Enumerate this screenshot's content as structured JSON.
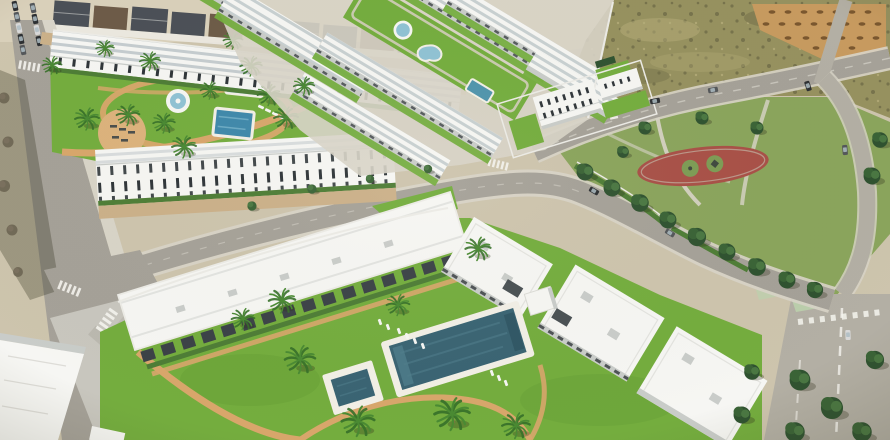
{
  "scene": {
    "type": "aerial-architectural-render",
    "description": "Aerial 3D render of a white Mediterranean residential development with landscaped gardens, swimming pools and palm trees, next to a public park, scrubland plots and asphalt roads",
    "areas": {
      "old_town": "Existing houses along the top edge",
      "left_street": "Tree-lined street with parked cars",
      "avenue": "Wide avenue at the lower-left intersection",
      "roads": "Asphalt access roads with zebra crossings",
      "complex1": "Upper apartment block with landscaped garden and pools",
      "complex2": "Diagonal townhouse rows around a linear lawn with pools",
      "standalone": "Detached white apartment building",
      "complex3": "Foreground residences around the main pool garden",
      "park": "Public park with lawns and mature trees",
      "playground": "Oval playground with red safety surface",
      "scrub": "Undeveloped scrubland plot",
      "dirt_lot": "Graded dirt lot with spoil heaps",
      "main_pool": "Main communal swimming pool",
      "trees": "Pine trees overhanging the roads"
    },
    "counts": {
      "swimming_pools": 8
    }
  },
  "colors": {
    "ground": "#cdc4ad",
    "sand": "#d9d0ba",
    "lane": "#cbb089",
    "roadD": "#a5a198",
    "roadM": "#b3afa4",
    "roadL": "#c8c6be",
    "sidewalk": "#d8d4c8",
    "wall": "#ecebe6",
    "lawn": "#74ad3e",
    "lawnD": "#5c9230",
    "park": "#8aa45c",
    "verge": "#6f9a3e",
    "bike": "#bcd3ae",
    "scrub": "#96915f",
    "scrubD": "#6f6b47",
    "scrubL": "#b5ad79",
    "dirt": "#c79a5f",
    "mound": "#7a572f",
    "white": "#f6f6f3",
    "shade": "#c9ccc9",
    "roofstripe": "#aab6bb",
    "facade": "#2f3539",
    "pergola": "#3b4247",
    "hedge": "#4e7d36",
    "treeD": "#2f5230",
    "treeM": "#3a6336",
    "treeL": "#4a7742",
    "trunk": "#8a6b4a",
    "bare": "#6a6150",
    "palm": "#4a8a33",
    "palmD": "#37702a",
    "poolDeep": "#3a6473",
    "poolMid": "#4f94ac",
    "poolBlue": "#3e88aa",
    "poolLight": "#8fc2d4",
    "deck": "#f2efe6",
    "path": "#d8a66b",
    "patio": "#dcb27c",
    "red": "#a85047",
    "playIn": "#7d9c55",
    "carD": "#2d3033",
    "carG": "#54575a",
    "carL": "#d8d8d8",
    "shadow": "rgba(45,45,25,0.3)",
    "zebra": "#f5f4ef",
    "roofA": "#4b5057",
    "roofB": "#6d5b48",
    "wallW": "#eceae3"
  }
}
